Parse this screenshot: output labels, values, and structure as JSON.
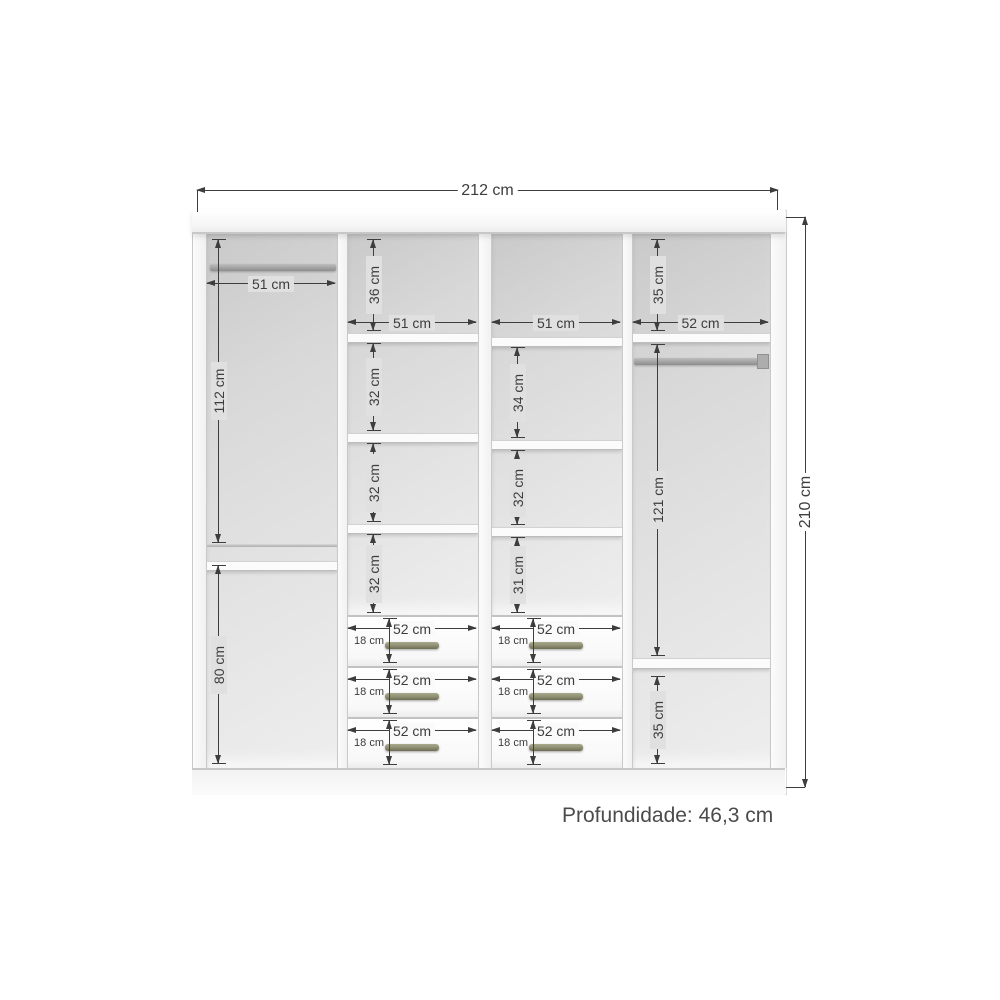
{
  "diagram": {
    "overall_width": "212 cm",
    "overall_height": "210 cm",
    "depth_note": "Profundidade: 46,3 cm"
  },
  "left_column": {
    "rod_width": "51 cm",
    "upper_section_height": "112 cm",
    "lower_section_height": "80 cm"
  },
  "mid_left_column": {
    "width": "51 cm",
    "top_cell_height": "36 cm",
    "cell_heights": [
      "32 cm",
      "32 cm",
      "32 cm"
    ]
  },
  "mid_right_column": {
    "width": "51 cm",
    "cell_heights": [
      "34 cm",
      "32 cm",
      "31 cm"
    ]
  },
  "right_column": {
    "width": "52 cm",
    "top_cell_height": "35 cm",
    "middle_section_height": "121 cm",
    "bottom_cell_height": "35 cm"
  },
  "drawers": {
    "width": "52 cm",
    "front_height": "18 cm"
  },
  "colors": {
    "dimension_lines": "#3d3d3d",
    "interior_gray": "#e0e0e0",
    "panel_white": "#f8f8f8",
    "handle_olive": "#8d8d72"
  }
}
